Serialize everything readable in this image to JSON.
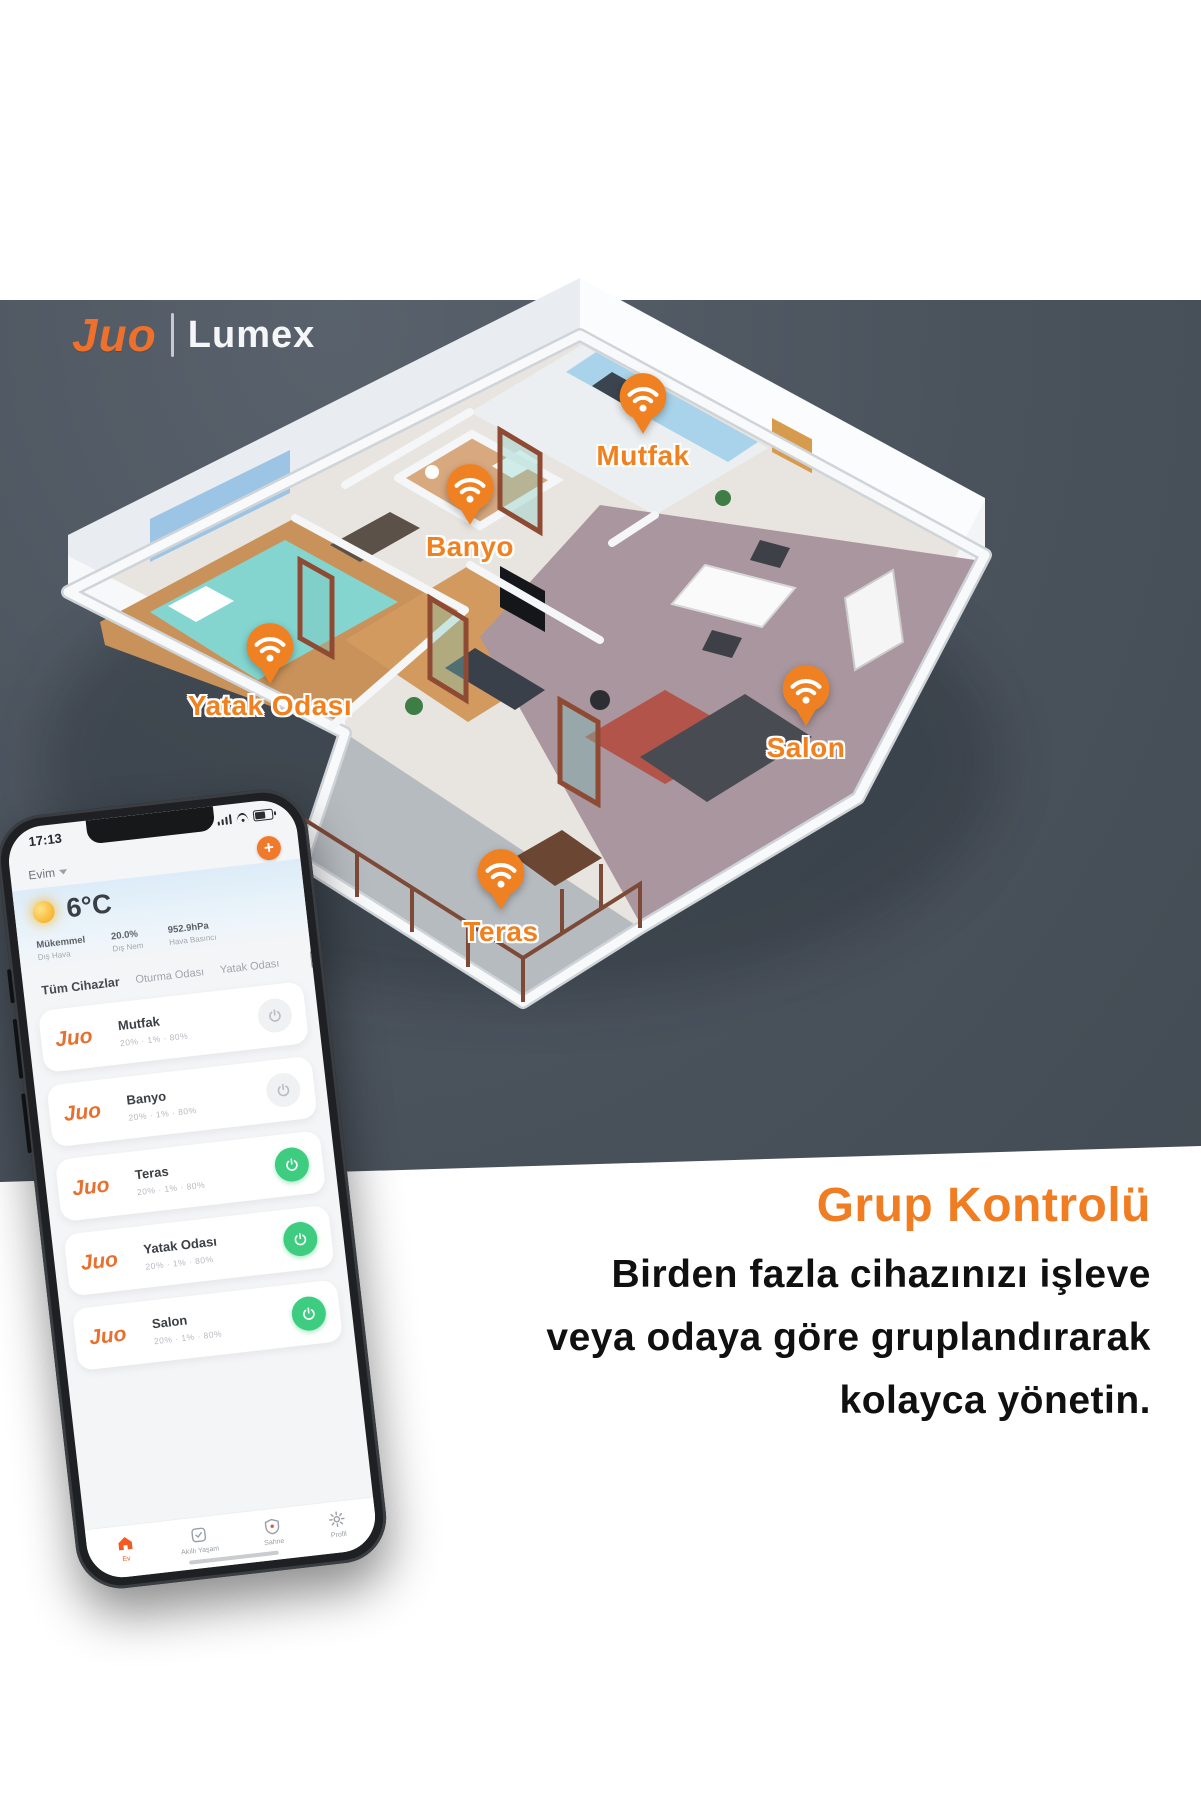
{
  "logo": {
    "brand": "Juo",
    "product": "Lumex"
  },
  "rooms": [
    {
      "id": "mutfak",
      "label": "Mutfak"
    },
    {
      "id": "banyo",
      "label": "Banyo"
    },
    {
      "id": "yatak-odasi",
      "label": "Yatak Odası"
    },
    {
      "id": "salon",
      "label": "Salon"
    },
    {
      "id": "teras",
      "label": "Teras"
    }
  ],
  "phone": {
    "status": {
      "time": "17:13"
    },
    "home": {
      "name": "Evim",
      "add_label": "+"
    },
    "weather": {
      "temp": "6°C",
      "stats": [
        {
          "value": "Mükemmel",
          "label": "Dış Hava"
        },
        {
          "value": "20.0%",
          "label": "Dış Nem"
        },
        {
          "value": "952.9hPa",
          "label": "Hava Basıncı"
        }
      ]
    },
    "tabs": [
      {
        "label": "Tüm Cihazlar",
        "active": true
      },
      {
        "label": "Oturma Odası",
        "active": false
      },
      {
        "label": "Yatak Odası",
        "active": false
      }
    ],
    "devices": [
      {
        "brand": "Juo",
        "name": "Mutfak",
        "stats": "20% · 1% · 80%",
        "on": false
      },
      {
        "brand": "Juo",
        "name": "Banyo",
        "stats": "20% · 1% · 80%",
        "on": false
      },
      {
        "brand": "Juo",
        "name": "Teras",
        "stats": "20% · 1% · 80%",
        "on": true
      },
      {
        "brand": "Juo",
        "name": "Yatak Odası",
        "stats": "20% · 1% · 80%",
        "on": true
      },
      {
        "brand": "Juo",
        "name": "Salon",
        "stats": "20% · 1% · 80%",
        "on": true
      }
    ],
    "nav": [
      {
        "label": "Ev",
        "active": true
      },
      {
        "label": "Akıllı Yaşam",
        "active": false
      },
      {
        "label": "Sahne",
        "active": false
      },
      {
        "label": "Profil",
        "active": false
      }
    ]
  },
  "promo": {
    "title": "Grup Kontrolü",
    "lines": [
      "Birden fazla cihazınızı işleve",
      "veya odaya göre gruplandırarak",
      "kolayca yönetin."
    ]
  },
  "colors": {
    "panel_gray": "#4a525c",
    "accent_orange": "#f07d22",
    "pin_orange": "#ef8120",
    "toggle_green": "#3ecd80",
    "body_text": "#101010"
  }
}
